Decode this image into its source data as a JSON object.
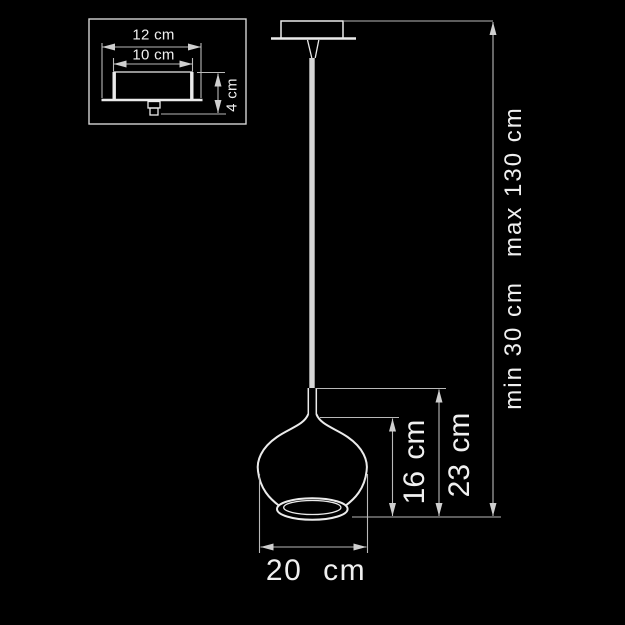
{
  "title": "Pendant lamp dimension diagram",
  "colors": {
    "background": "#000000",
    "line": "#ebebeb",
    "dim-line": "#b9b9b9",
    "text": "#f0f0f0",
    "cord": "#d6d6d6"
  },
  "inset": {
    "labels": {
      "outer_width": "12 cm",
      "inner_width": "10 cm",
      "height": "4 cm"
    }
  },
  "main": {
    "labels": {
      "shade_height": "16 cm",
      "fixture_height": "23 cm",
      "suspension_min": "min 30 cm",
      "suspension_max": "max 130 cm",
      "shade_width": "20 cm"
    }
  }
}
